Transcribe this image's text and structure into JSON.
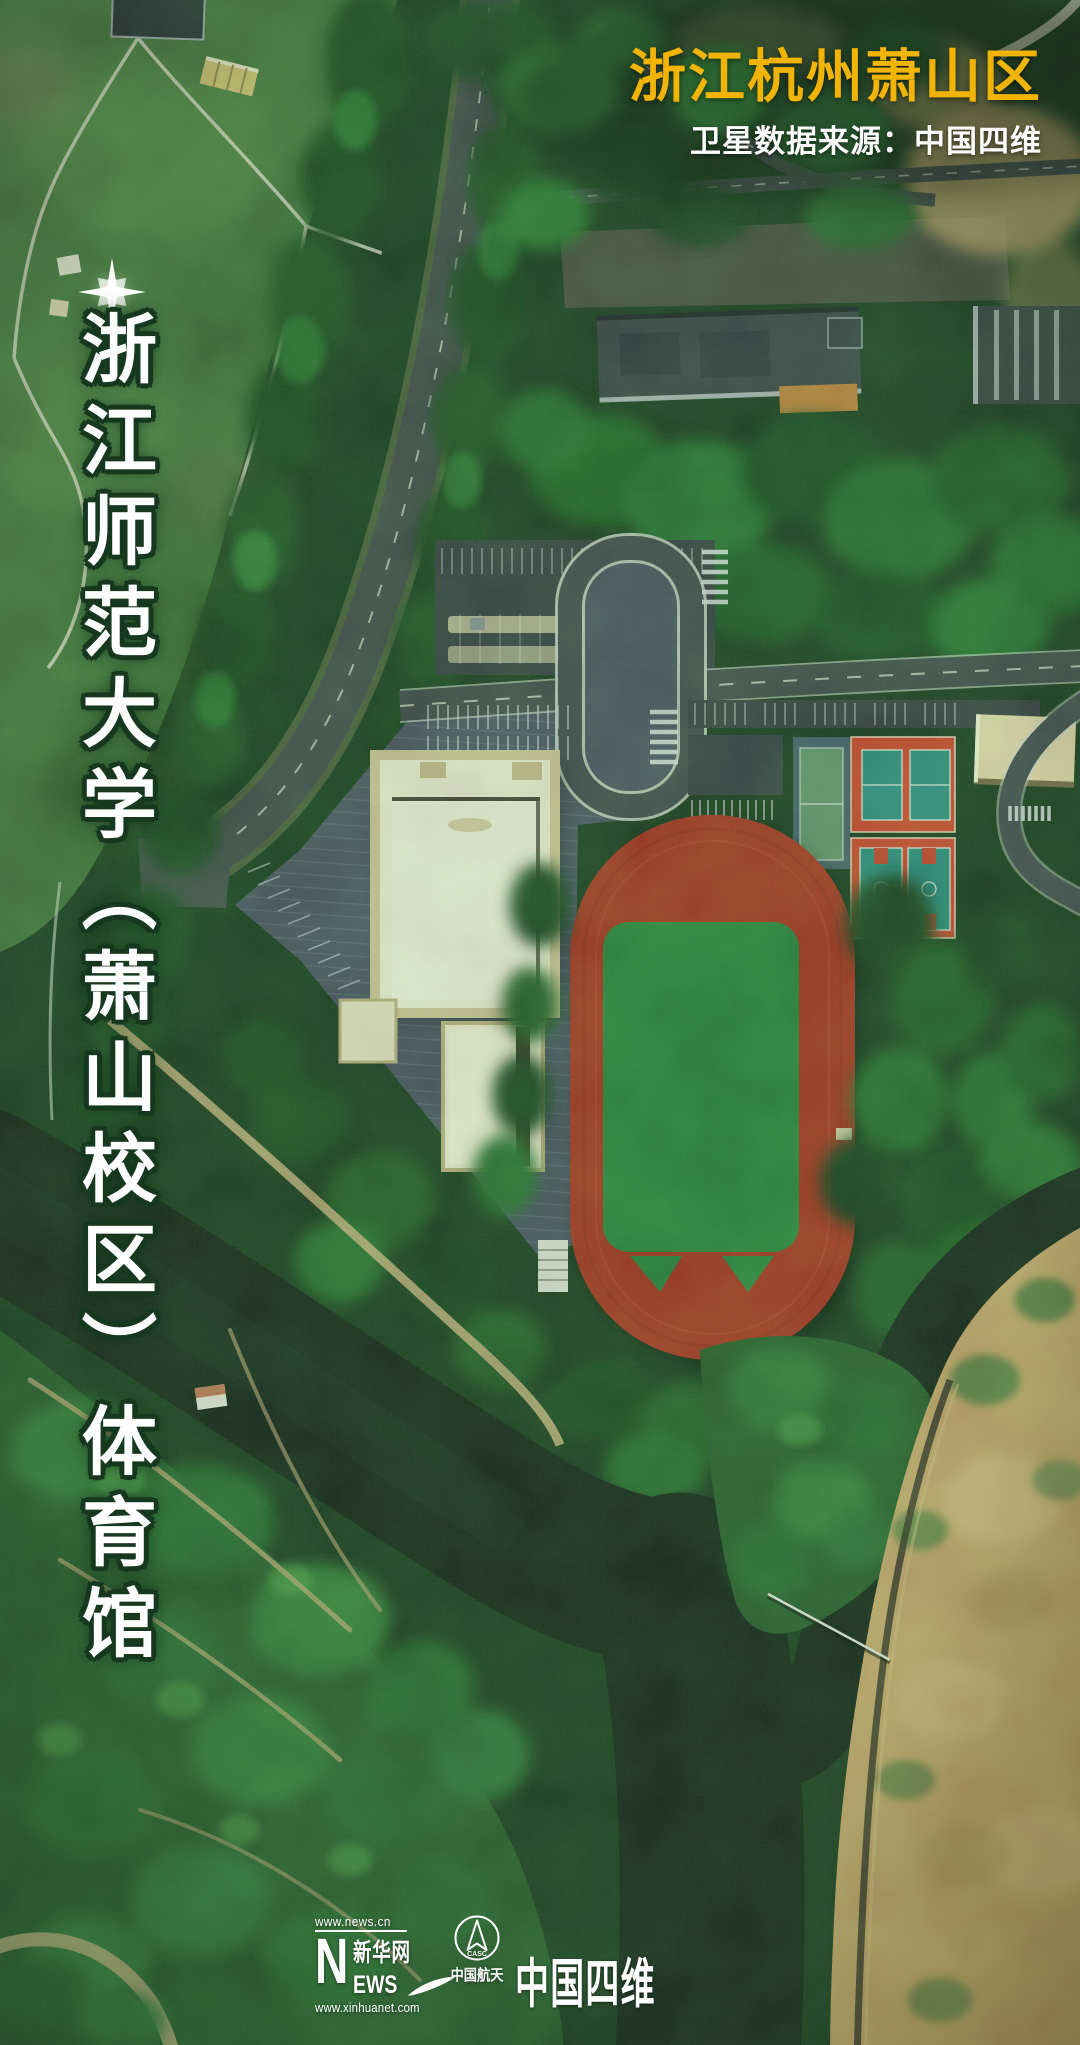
{
  "header": {
    "region_title": "浙江杭州萧山区",
    "source_credit": "卫星数据来源：中国四维"
  },
  "left_caption": {
    "text": "浙江师范大学（萧山校区）体育馆"
  },
  "footer": {
    "xinhuanet": {
      "url_top": "www.news.cn",
      "n": "N",
      "chinese": "新华网",
      "ews": "EWS",
      "url_bottom": "www.xinhuanet.com"
    },
    "casc": {
      "abbr": "CASC",
      "name": "中国航天"
    },
    "siwei": {
      "name": "中国四维"
    }
  },
  "colors": {
    "title_yellow": "#f1b402",
    "text_white": "#ffffff",
    "caption_outline_green": "#16381f",
    "track_red": "#b03122",
    "infield_green": "#2d8640",
    "court_red": "#d7462e",
    "court_teal": "#2f8f86",
    "gym_cream": "#f8f1dc",
    "water_dark": "#16231b",
    "sand_tan": "#cfa86e"
  }
}
